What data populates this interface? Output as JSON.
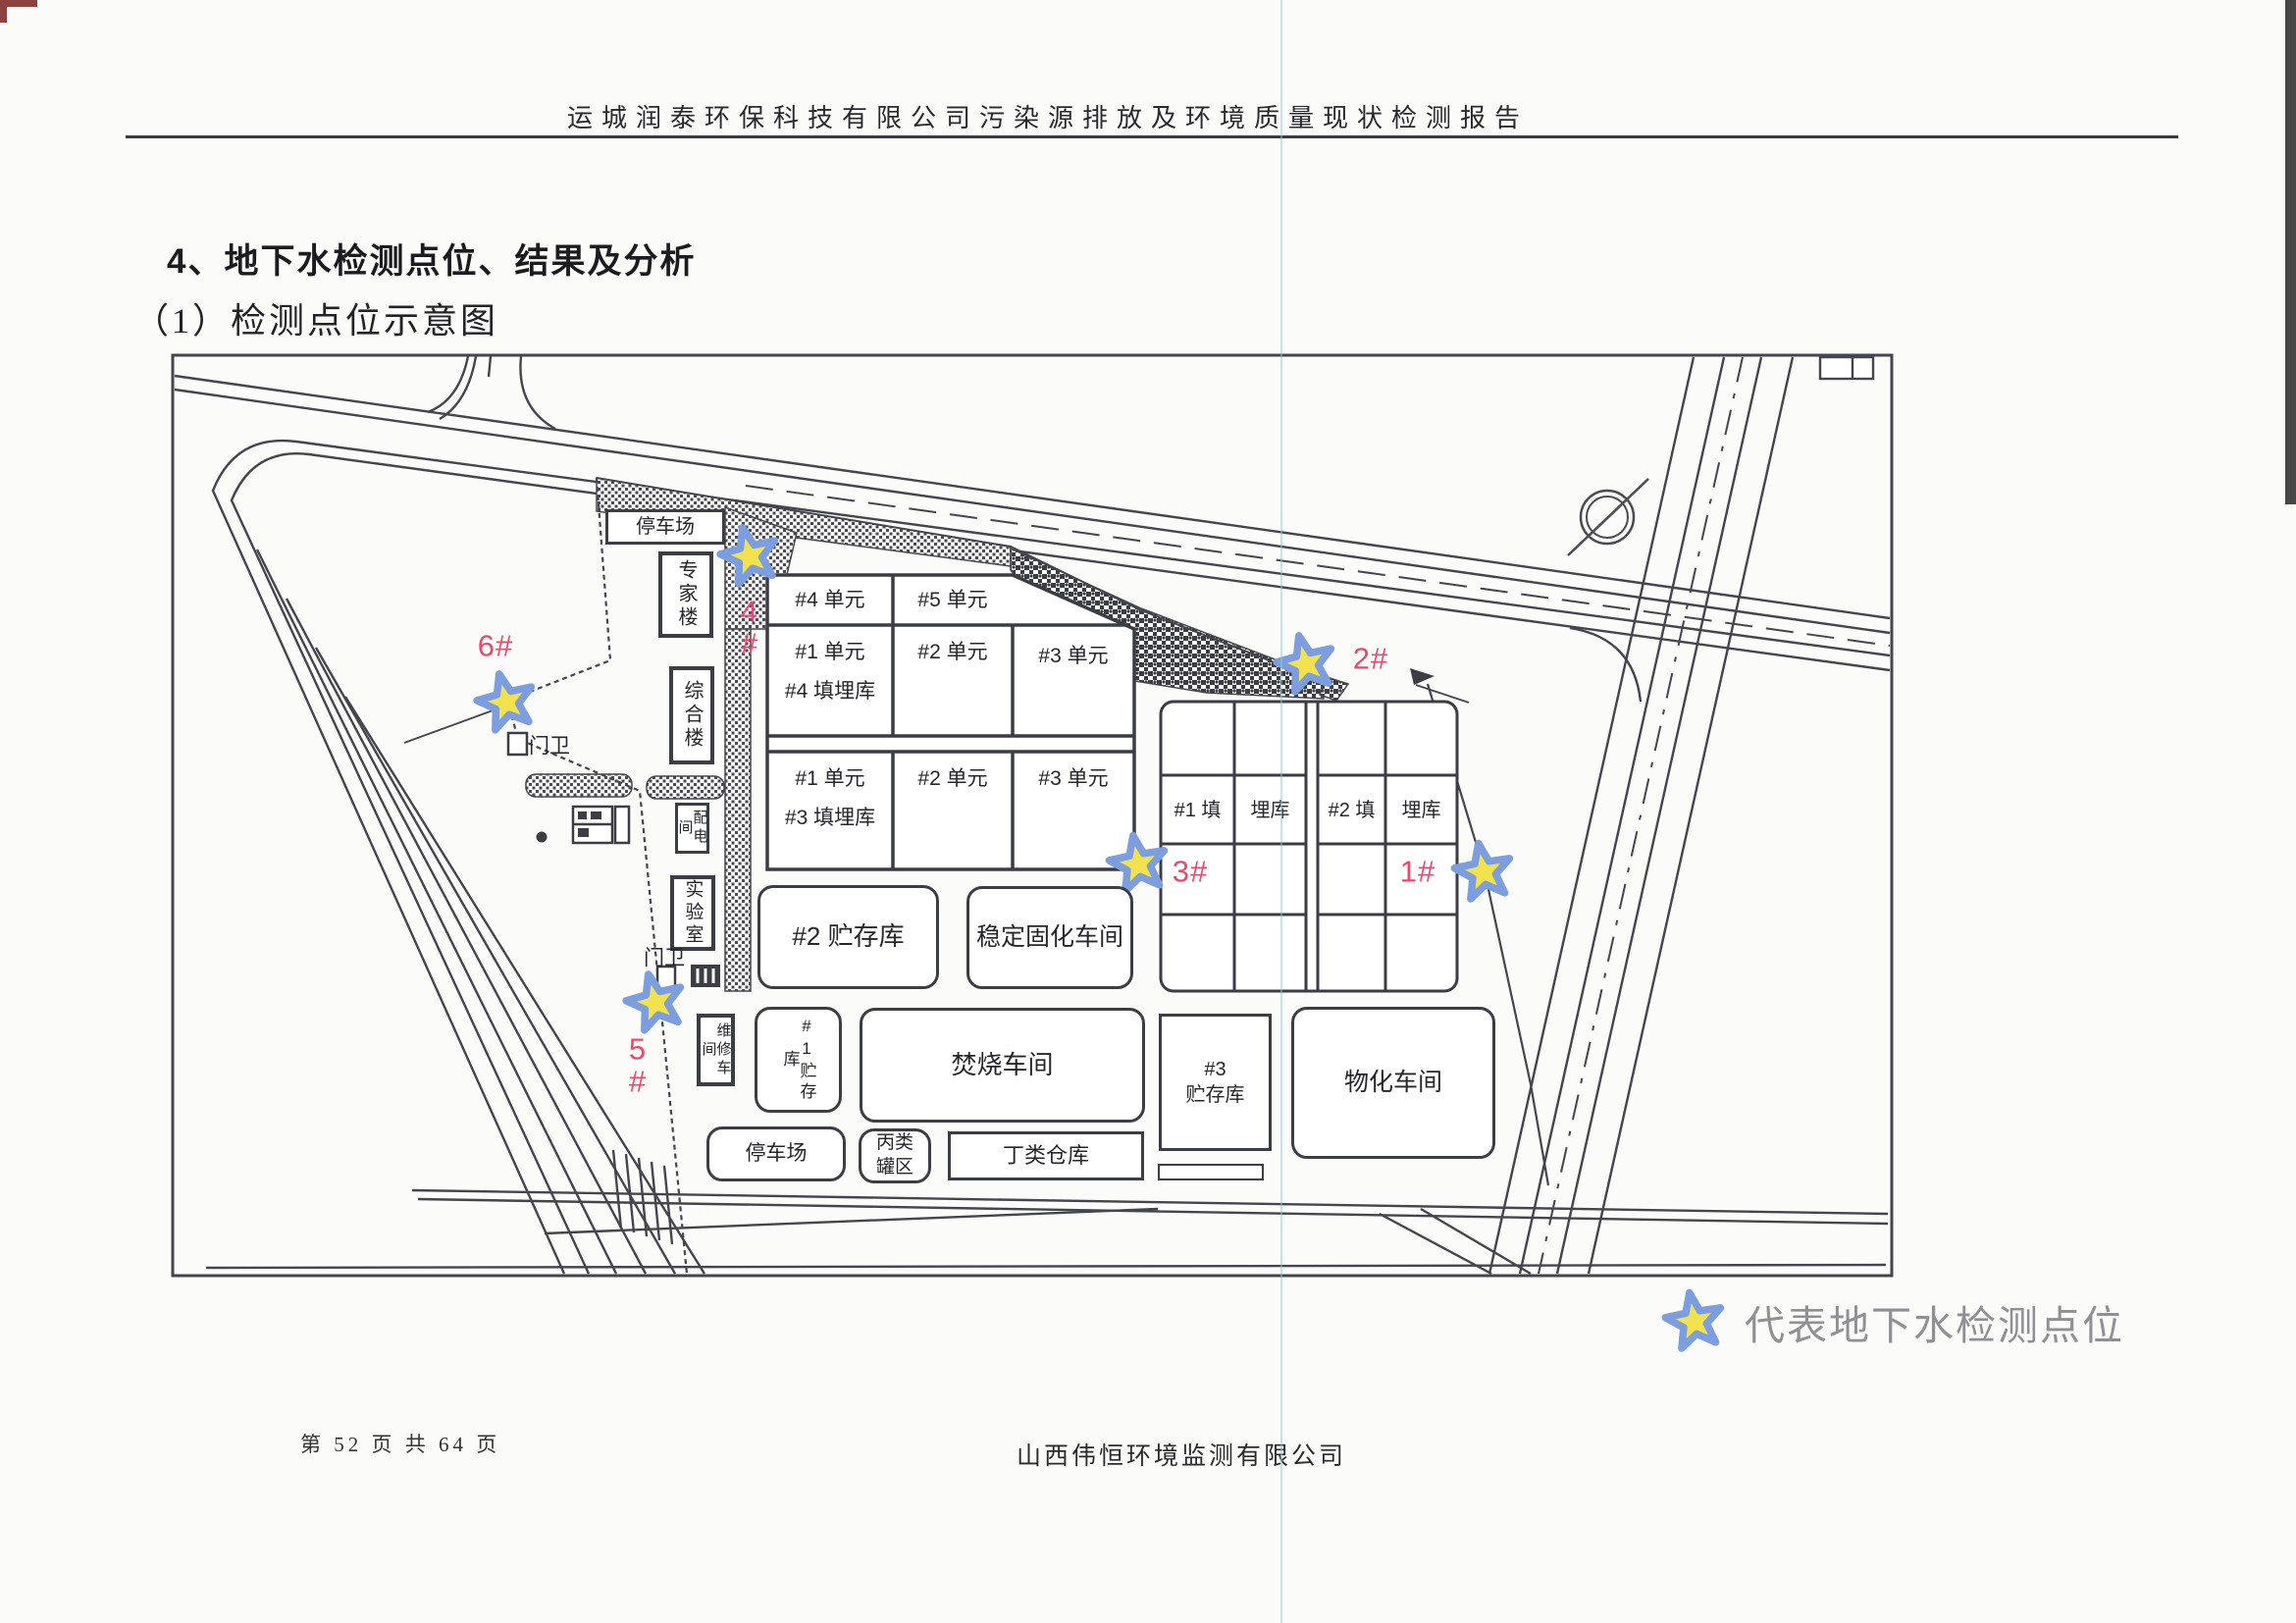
{
  "page": {
    "header_text": "运城润泰环保科技有限公司污染源排放及环境质量现状检测报告",
    "section_title": "4、地下水检测点位、结果及分析",
    "section_subtitle": "（1）检测点位示意图",
    "footer_page": "第 52 页 共 64 页",
    "footer_company": "山西伟恒环境监测有限公司"
  },
  "legend": {
    "marker": "star-icon",
    "text": "代表地下水检测点位"
  },
  "map": {
    "buildings": [
      {
        "id": "parking-north",
        "label": "停车场"
      },
      {
        "id": "expert-building",
        "label": "专家楼"
      },
      {
        "id": "office-building",
        "label": "综合楼"
      },
      {
        "id": "power-room",
        "label": "配电间"
      },
      {
        "id": "laboratory",
        "label": "实验室"
      },
      {
        "id": "gate-north",
        "label": "门卫"
      },
      {
        "id": "gate-south",
        "label": "门卫"
      },
      {
        "id": "maintenance-workshop",
        "label": "维修车间"
      },
      {
        "id": "storage-1",
        "label": "#1贮存库"
      },
      {
        "id": "storage-2",
        "label": "#2 贮存库"
      },
      {
        "id": "stabilization-workshop",
        "label": "稳定固化车间"
      },
      {
        "id": "incineration-workshop",
        "label": "焚烧车间"
      },
      {
        "id": "parking-south",
        "label": "停车场"
      },
      {
        "id": "tank-area",
        "label": "丙类\n罐区"
      },
      {
        "id": "warehouse-d",
        "label": "丁类仓库"
      },
      {
        "id": "storage-3",
        "label": "#3\n贮存库"
      },
      {
        "id": "physchem-workshop",
        "label": "物化车间"
      }
    ],
    "landfill_center": {
      "row1": [
        "#4 单元",
        "#5 单元"
      ],
      "row2": [
        "#1 单元\n#4 填埋库",
        "#2 单元",
        "#3 单元"
      ],
      "row3": [
        "#1 单元\n#3 填埋库",
        "#2 单元",
        "#3 单元"
      ]
    },
    "landfill_east_cells": [
      "#1 填",
      "埋库",
      "#2 填",
      "埋库"
    ],
    "monitoring_points": [
      {
        "id": "1#"
      },
      {
        "id": "2#"
      },
      {
        "id": "3#"
      },
      {
        "id": "4#"
      },
      {
        "id": "5#"
      },
      {
        "id": "6#"
      }
    ]
  },
  "colors": {
    "star_fill": "#f2e34e",
    "star_stroke": "#7d9ede",
    "point_label": "#e8496f",
    "map_line": "#45454e",
    "legend_text": "#8f9093"
  }
}
